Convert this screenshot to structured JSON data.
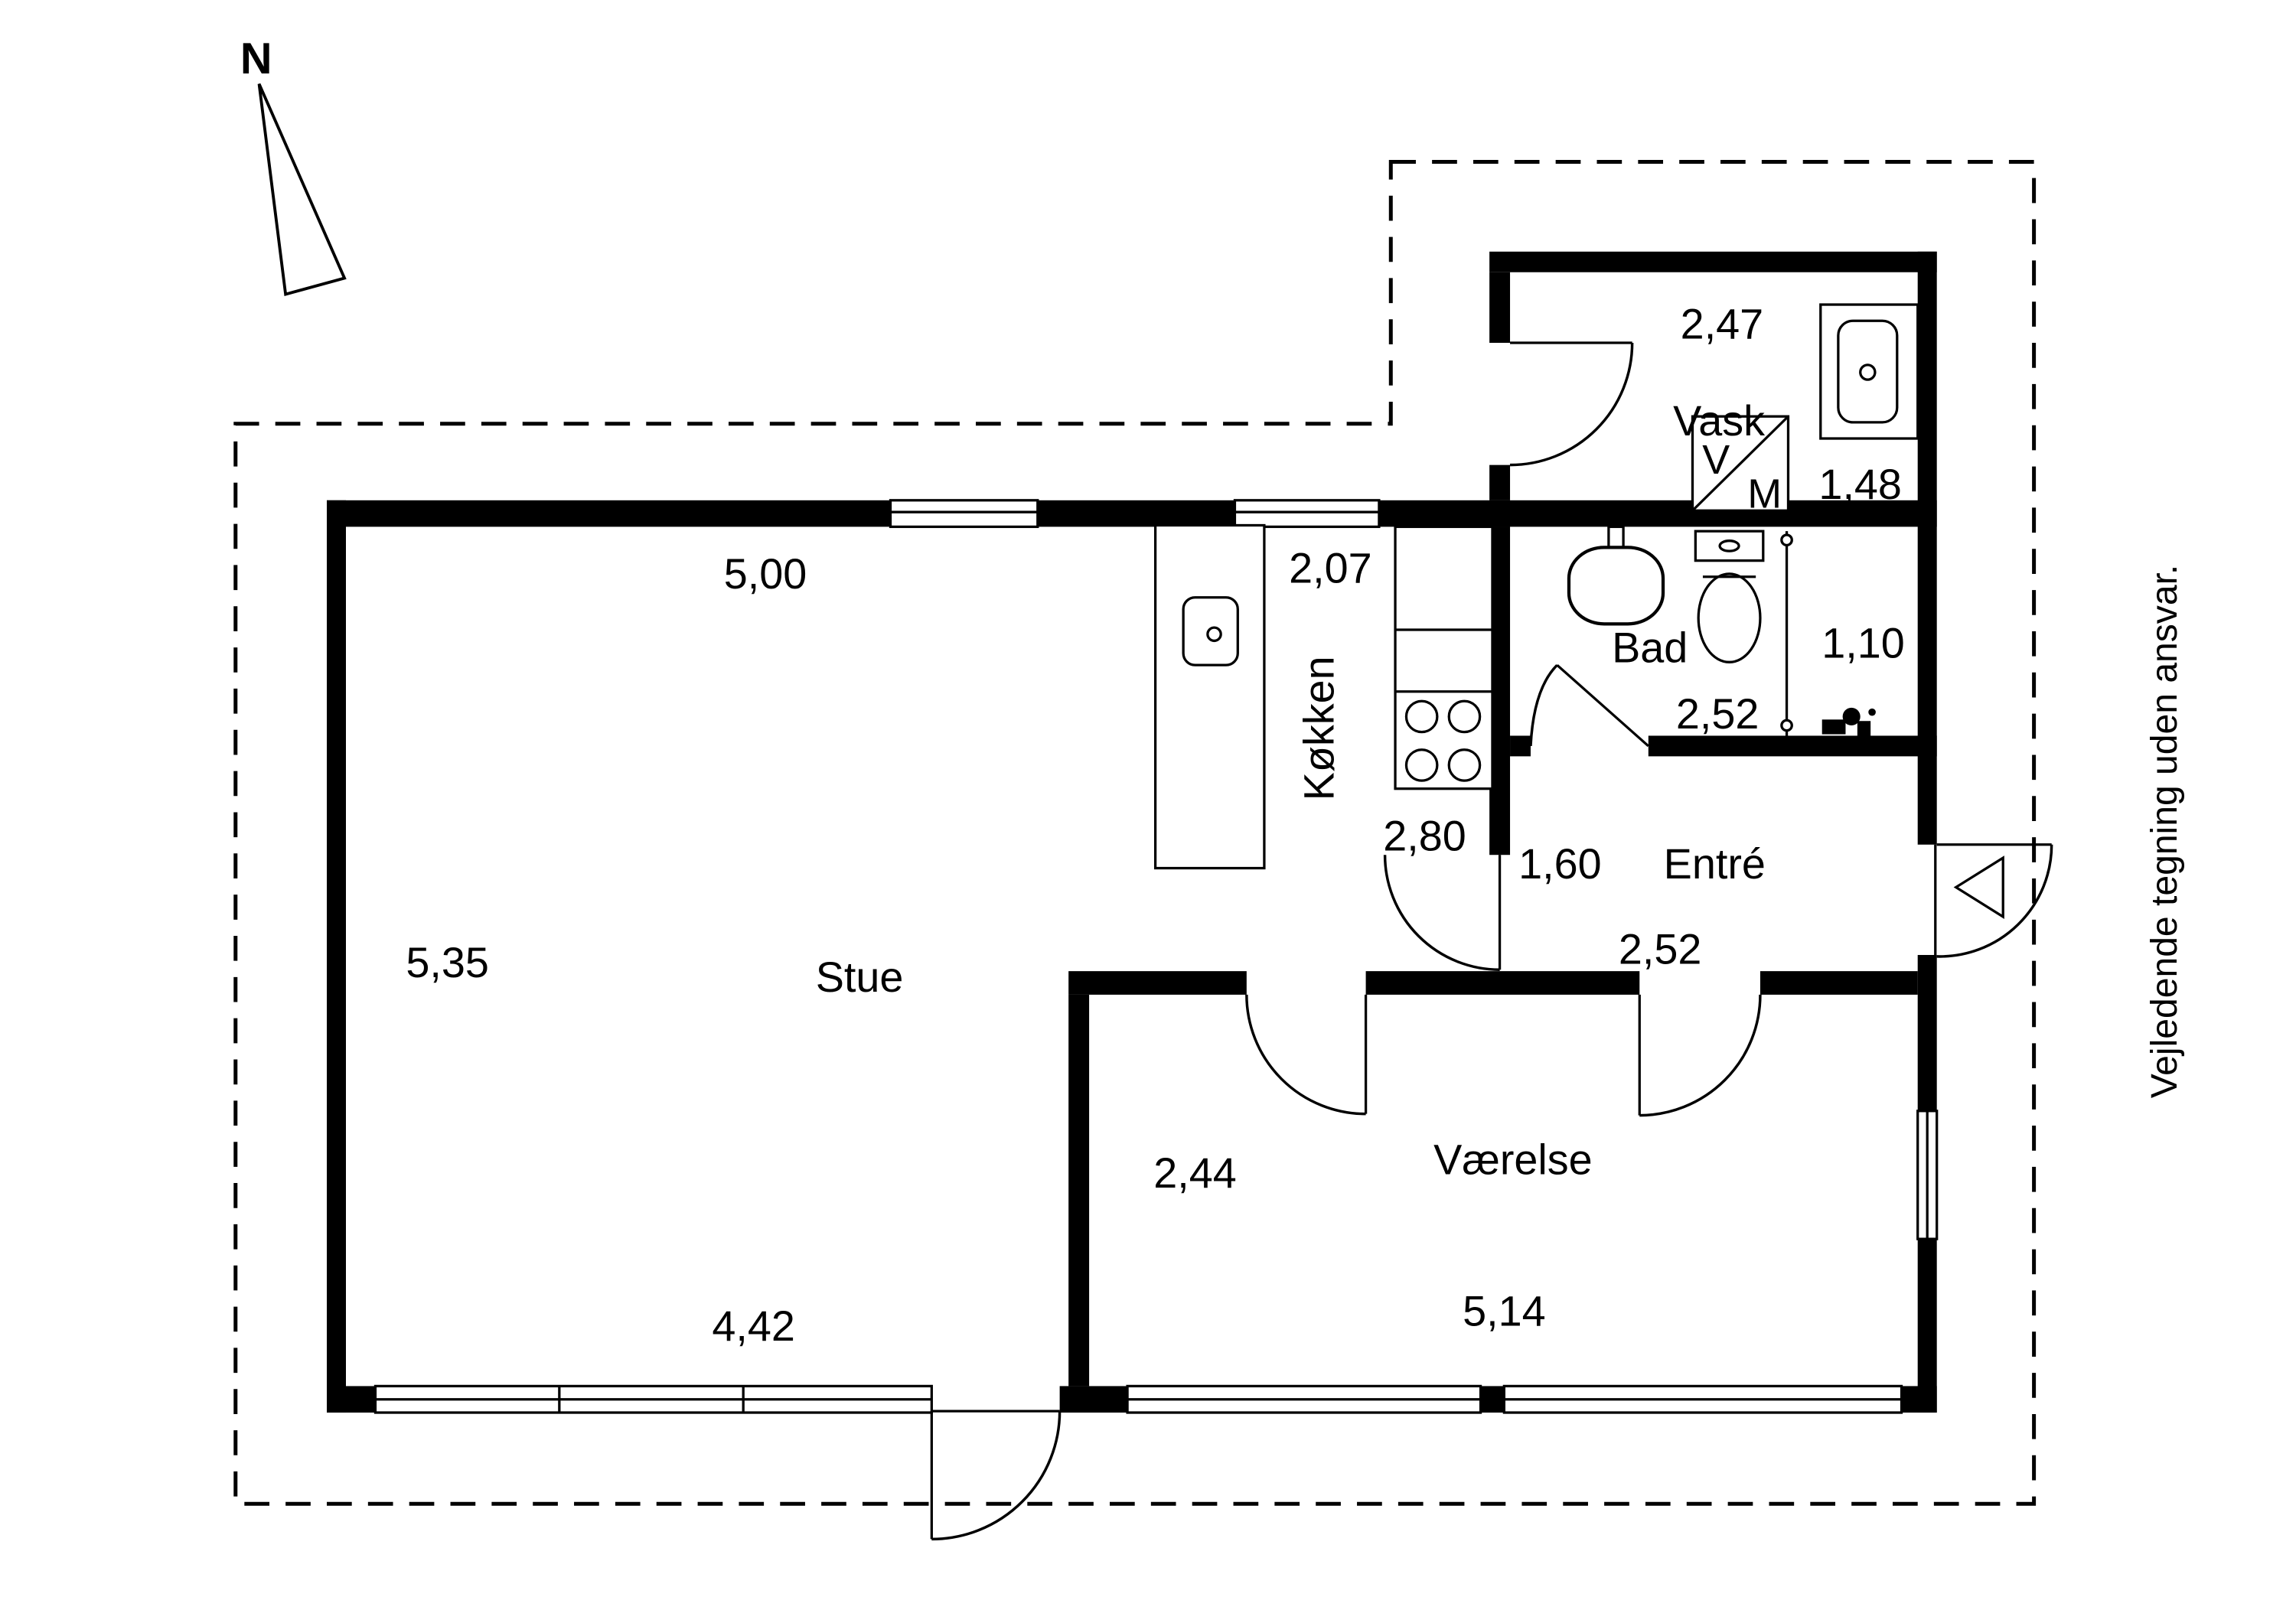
{
  "plan": {
    "type": "floorplan",
    "north_label": "N",
    "disclaimer": "Vejledende tegning uden ansvar.",
    "colors": {
      "walls": "#000000",
      "background": "#ffffff",
      "lines": "#000000"
    },
    "rooms": {
      "stue": {
        "label": "Stue",
        "dim_top": "5,00",
        "dim_left": "5,35",
        "dim_bottom_window": "4,42"
      },
      "kokken": {
        "label": "Køkken",
        "dim_top": "2,07",
        "dim_bottom": "2,80"
      },
      "vask": {
        "label": "Vask",
        "dim_top": "2,47",
        "dim_right": "1,48"
      },
      "bad": {
        "label": "Bad",
        "dim_bottom": "2,52",
        "dim_shower": "1,10"
      },
      "entre": {
        "label": "Entré",
        "dim_left": "1,60",
        "dim_bottom": "2,52"
      },
      "vaerelse": {
        "label": "Værelse",
        "dim_left": "2,44",
        "dim_bottom": "5,14"
      }
    },
    "washer": {
      "letter_top": "V",
      "letter_bottom": "M"
    }
  }
}
